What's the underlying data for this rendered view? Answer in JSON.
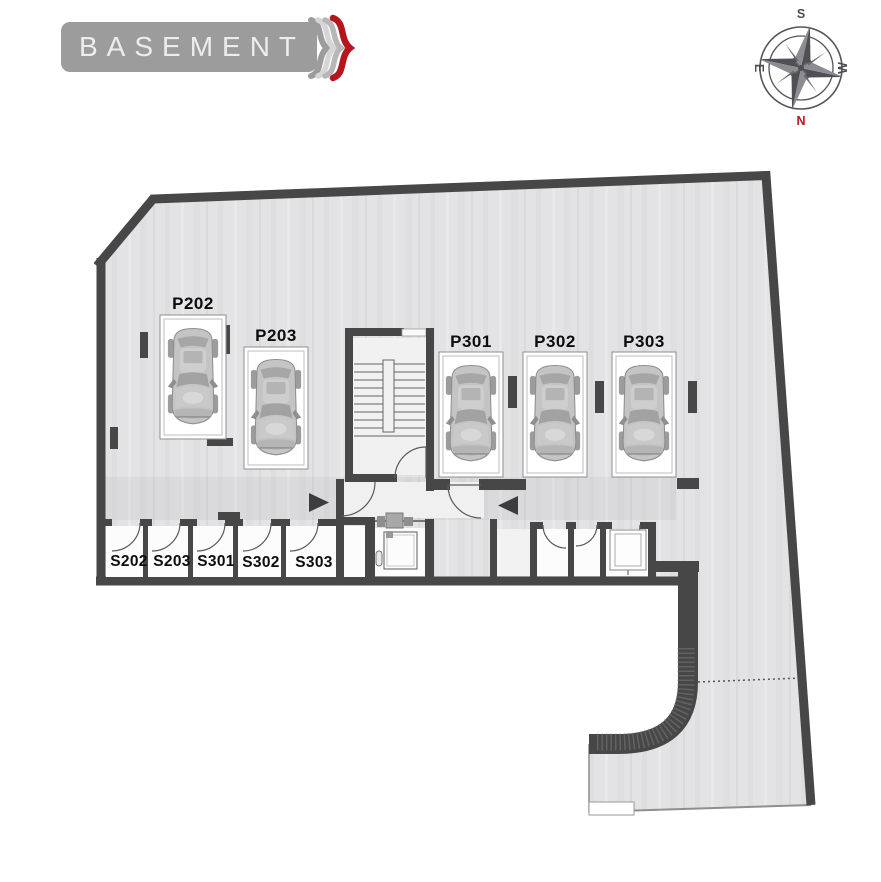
{
  "banner": {
    "title": "BASEMENT"
  },
  "compass": {
    "top": "S",
    "bottom": "N",
    "left": "E",
    "right": "W",
    "north_color": "#b3161c"
  },
  "plan": {
    "parking_spots": [
      {
        "label": "P202"
      },
      {
        "label": "P203"
      },
      {
        "label": "P301"
      },
      {
        "label": "P302"
      },
      {
        "label": "P303"
      }
    ],
    "storage_rooms": [
      {
        "label": "S202"
      },
      {
        "label": "S203"
      },
      {
        "label": "S301"
      },
      {
        "label": "S302"
      },
      {
        "label": "S303"
      }
    ]
  },
  "icons": {
    "decoration": "triple-brace",
    "compass": "compass-rose",
    "flow_arrows": [
      "arrow-right",
      "arrow-left"
    ],
    "car": "car-top-view"
  },
  "colors": {
    "wall": "#474747",
    "floor": "#e3e3e5",
    "banner_gray": "#9c9c9c",
    "accent_red": "#b5161d"
  }
}
